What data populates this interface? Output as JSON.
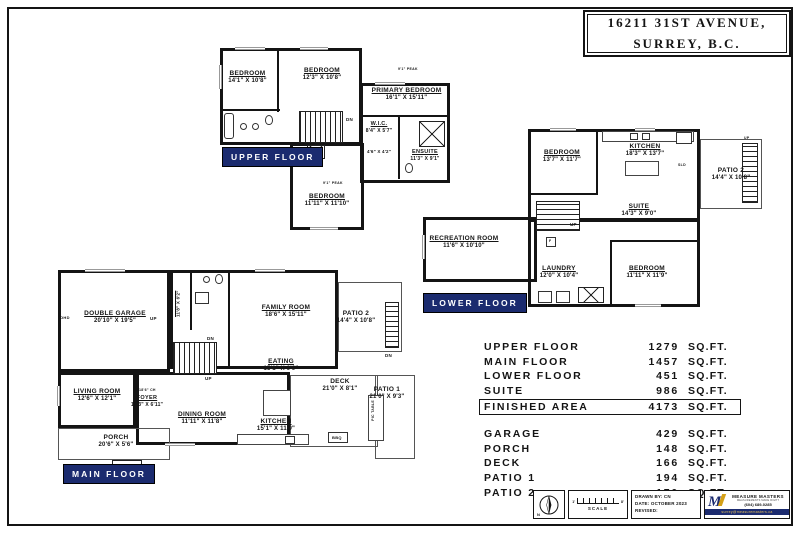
{
  "page": {
    "title_line1": "16211 31ST AVENUE,",
    "title_line2": "SURREY, B.C."
  },
  "floors": {
    "upper": {
      "label": "UPPER FLOOR",
      "rooms": [
        {
          "name": "BEDROOM",
          "dims": "14'1\" X 10'8\""
        },
        {
          "name": "BEDROOM",
          "dims": "12'3\" X 10'8\""
        },
        {
          "name": "PRIMARY BEDROOM",
          "dims": "16'1\" X 15'11\""
        },
        {
          "name": "W.I.C.",
          "dims": "8'4\" X 5'7\""
        },
        {
          "name": "ENSUITE",
          "dims": "11'3\" X 9'1\""
        },
        {
          "name": "",
          "dims": "4'6\" X 4'2\""
        },
        {
          "name": "BEDROOM",
          "dims": "11'11\" X 11'10\""
        }
      ],
      "ann": {
        "dn": "DN",
        "peak": "9'1\" PEAK"
      }
    },
    "lower": {
      "label": "LOWER FLOOR",
      "rooms": [
        {
          "name": "BEDROOM",
          "dims": "13'7\" X 11'7\""
        },
        {
          "name": "KITCHEN",
          "dims": "18'3\" X 13'7\""
        },
        {
          "name": "PATIO 2",
          "dims": "14'4\" X 10'8\""
        },
        {
          "name": "SUITE",
          "dims": "14'3\" X 9'0\""
        },
        {
          "name": "RECREATION ROOM",
          "dims": "11'6\" X 10'10\""
        },
        {
          "name": "LAUNDRY",
          "dims": "12'0\" X 10'4\""
        },
        {
          "name": "BEDROOM",
          "dims": "11'11\" X 11'9\""
        }
      ],
      "ann": {
        "up": "UP",
        "sld": "SLD",
        "f": "F"
      }
    },
    "main": {
      "label": "MAIN FLOOR",
      "rooms": [
        {
          "name": "DOUBLE GARAGE",
          "dims": "20'10\" X 19'5\""
        },
        {
          "name": "LAUNDRY",
          "dims": "11'8\" X 6'2\""
        },
        {
          "name": "FAMILY ROOM",
          "dims": "18'6\" X 15'11\""
        },
        {
          "name": "PATIO 2",
          "dims": "14'4\" X 10'8\""
        },
        {
          "name": "LIVING ROOM",
          "dims": "12'6\" X 12'1\""
        },
        {
          "name": "FOYER",
          "dims": "10'3\" X 6'11\""
        },
        {
          "name": "DINING ROOM",
          "dims": "11'11\" X 11'8\""
        },
        {
          "name": "EATING",
          "dims": "15'1\" X 9'9\""
        },
        {
          "name": "DECK",
          "dims": "21'0\" X 8'1\""
        },
        {
          "name": "PATIO 1",
          "dims": "21'0\" X 9'3\""
        },
        {
          "name": "KITCHEN",
          "dims": "15'1\" X 11'9\""
        },
        {
          "name": "PORCH",
          "dims": "20'6\" X 5'6\""
        }
      ],
      "ann": {
        "up": "UP",
        "dn": "DN",
        "ohd": "OHD",
        "bbq": "BBQ",
        "pic": "PIC TABLE",
        "ch": "18'6\" CH"
      }
    }
  },
  "areas": {
    "unit": "SQ.FT.",
    "finished": [
      {
        "label": "UPPER FLOOR",
        "value": "1279"
      },
      {
        "label": "MAIN FLOOR",
        "value": "1457"
      },
      {
        "label": "LOWER FLOOR",
        "value": "451"
      },
      {
        "label": "SUITE",
        "value": "986"
      }
    ],
    "total": {
      "label": "FINISHED AREA",
      "value": "4173"
    },
    "outdoor": [
      {
        "label": "GARAGE",
        "value": "429"
      },
      {
        "label": "PORCH",
        "value": "148"
      },
      {
        "label": "DECK",
        "value": "166"
      },
      {
        "label": "PATIO 1",
        "value": "194"
      },
      {
        "label": "PATIO 2",
        "value": "170"
      }
    ]
  },
  "footer": {
    "north": "N",
    "scale": {
      "label": "SCALE",
      "start": "1'",
      "end": "8'"
    },
    "drawn": {
      "by": "DRAWN BY: CN",
      "date": "DATE: OCTOBER 2023",
      "revised": "REVISED:"
    },
    "logo": {
      "mark": "M",
      "company": "MEASURE MASTERS",
      "tagline": "MEASUREMENTS MADE RIGHT",
      "phone": "(604) 689-0285",
      "email": "surrey@measuremasters.ca"
    }
  }
}
